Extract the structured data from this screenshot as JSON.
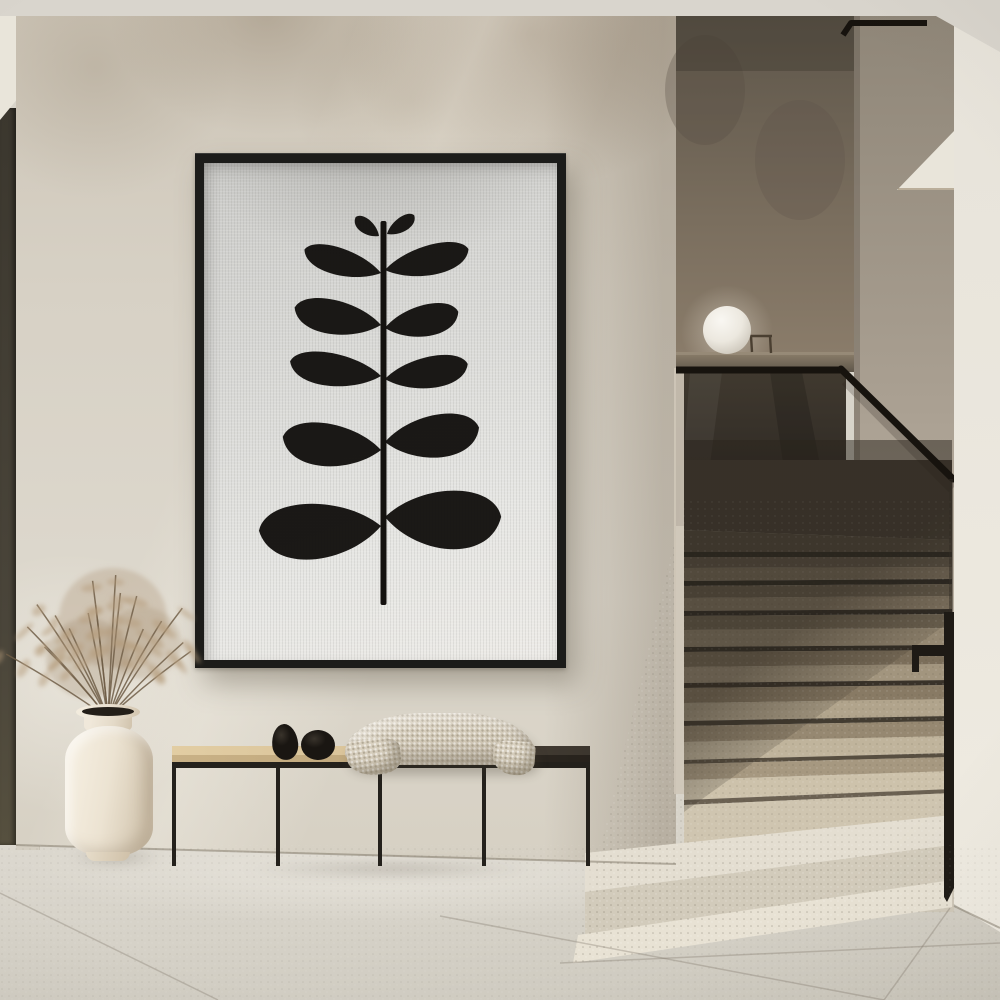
{
  "scene": {
    "description": "Minimalist hallway interior: framed black botanical print on beige plaster wall, black metal bench with oak seat, decorative stones and knit throw, cream vase with dried pampas grass, terrazzo staircase with smoked-glass balustrade and black handrail, white globe lamp on half-wall ledge",
    "objects": [
      "plaster-wall",
      "framed-botanical-print",
      "metal-bench",
      "decorative-stones",
      "knit-throw",
      "ceramic-vase",
      "dried-pampas-grass",
      "terrazzo-staircase",
      "smoked-glass-balustrade",
      "black-handrail",
      "globe-lamp",
      "stone-tile-floor"
    ]
  },
  "palette": {
    "ceiling": "#d9d5cd",
    "wall": "#d7d1c5",
    "left_strip": "#3b372e",
    "soffit": "#e9e5da",
    "frame": "#1c1c1a",
    "canvas": "#dcdcd9",
    "ink": "#14120f",
    "bench_wood": "#d8c298",
    "bench_wood_dark": "#3c362e",
    "bench_metal": "#24211c",
    "blanket": "#d5ccbb",
    "stone": "#1f1b17",
    "vase": "#ece3d2",
    "grass_dark": "#6f5d46",
    "grass_light": "#b59c79",
    "recess_top": "#6a6154",
    "recess_bottom": "#887a68",
    "ledge": "#81745f",
    "glass_top": "#3f382e",
    "glass_bottom": "#2a2620",
    "rail": "#17130e",
    "trim": "#1e1a15",
    "right_wall_top": "#958c7d",
    "right_wall_bottom": "#cfc8b9",
    "bright_wall": "#eae6dd",
    "step_dark": "#443d33",
    "step_light": "#e8e2d4",
    "lamp": "#f6f4ee",
    "floor_a": "#d8d4ca",
    "floor_b": "#ccc8bd"
  },
  "artwork": {
    "stem": {
      "x": 176.5,
      "y": 58,
      "w": 6,
      "h": 384
    },
    "leaves": [
      {
        "s": "L",
        "tx": 175,
        "ty": 73,
        "len": 30,
        "half": 10,
        "ang": 36
      },
      {
        "s": "R",
        "tx": 183,
        "ty": 71,
        "len": 33,
        "half": 10,
        "ang": -32
      },
      {
        "s": "L",
        "tx": 177,
        "ty": 110,
        "len": 80,
        "half": 19,
        "ang": 15
      },
      {
        "s": "R",
        "tx": 181,
        "ty": 107,
        "len": 86,
        "half": 21,
        "ang": -12
      },
      {
        "s": "L",
        "tx": 177,
        "ty": 162,
        "len": 88,
        "half": 24,
        "ang": 9
      },
      {
        "s": "R",
        "tx": 181,
        "ty": 165,
        "len": 75,
        "half": 22,
        "ang": -10
      },
      {
        "s": "L",
        "tx": 177,
        "ty": 213,
        "len": 92,
        "half": 23,
        "ang": 7
      },
      {
        "s": "R",
        "tx": 181,
        "ty": 216,
        "len": 84,
        "half": 22,
        "ang": -8
      },
      {
        "s": "L",
        "tx": 177,
        "ty": 287,
        "len": 99,
        "half": 30,
        "ang": 5
      },
      {
        "s": "R",
        "tx": 181,
        "ty": 279,
        "len": 95,
        "half": 30,
        "ang": -6
      },
      {
        "s": "L",
        "tx": 177,
        "ty": 363,
        "len": 122,
        "half": 39,
        "ang": -5
      },
      {
        "s": "R",
        "tx": 181,
        "ty": 354,
        "len": 116,
        "half": 41,
        "ang": 3
      }
    ]
  },
  "stairs": {
    "xl": 684,
    "xr": 952,
    "bands": [
      [
        460,
        460,
        530,
        540,
        "#443d33"
      ],
      [
        530,
        540,
        552,
        552,
        "#50483c"
      ],
      [
        552,
        552,
        557,
        557,
        "#2b2721"
      ],
      [
        557,
        557,
        568,
        567,
        "#5e5547"
      ],
      [
        568,
        567,
        581,
        579,
        "#7b6f5d"
      ],
      [
        581,
        579,
        586,
        584,
        "#2b2721"
      ],
      [
        586,
        584,
        598,
        596,
        "#665c4c"
      ],
      [
        598,
        596,
        611,
        609,
        "#877a66"
      ],
      [
        611,
        609,
        616,
        614,
        "#2f2a23"
      ],
      [
        616,
        614,
        630,
        628,
        "#6f6452"
      ],
      [
        630,
        628,
        647,
        645,
        "#958872"
      ],
      [
        647,
        645,
        652,
        650,
        "#332e26"
      ],
      [
        652,
        650,
        667,
        664,
        "#7b6e5a"
      ],
      [
        667,
        664,
        683,
        680,
        "#a2957e"
      ],
      [
        683,
        680,
        688,
        685,
        "#393229"
      ],
      [
        688,
        685,
        703,
        699,
        "#887a64"
      ],
      [
        703,
        699,
        721,
        716,
        "#b1a48c"
      ],
      [
        721,
        716,
        726,
        721,
        "#433c31"
      ],
      [
        726,
        721,
        742,
        736,
        "#968871"
      ],
      [
        742,
        736,
        760,
        753,
        "#c0b49c"
      ],
      [
        760,
        753,
        764,
        757,
        "#574e40"
      ],
      [
        764,
        757,
        780,
        771,
        "#a69880"
      ],
      [
        780,
        771,
        800,
        789,
        "#cdc2ab"
      ],
      [
        800,
        789,
        805,
        793,
        "#6b6152"
      ],
      [
        805,
        793,
        853,
        815,
        "#cfc5b0"
      ]
    ],
    "extras": [
      {
        "pts": "585,853 952,815 952,845 585,892",
        "c": "#e4ded1"
      },
      {
        "pts": "585,892 952,845 952,880 585,935",
        "c": "#d2cbbb"
      },
      {
        "pts": "578,935 952,880 952,907 573,963",
        "c": "#e8e2d4"
      }
    ],
    "seams": [
      [
        0,
        893,
        218,
        1000
      ],
      [
        440,
        916,
        884,
        1000
      ],
      [
        884,
        1000,
        950,
        908
      ],
      [
        560,
        963,
        1000,
        943
      ]
    ]
  },
  "grass": {
    "count": 17,
    "base": [
      90,
      185
    ],
    "angle_min": -55,
    "angle_span": 105,
    "len_min": 95,
    "len_span": 55
  }
}
